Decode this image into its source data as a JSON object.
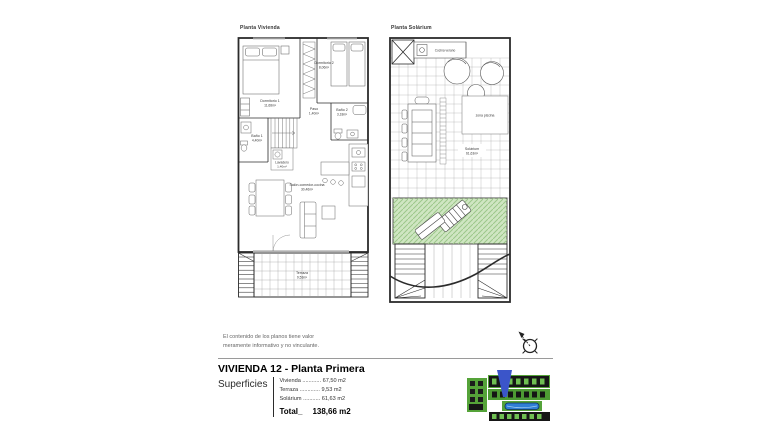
{
  "disclaimer": {
    "line1": "El contenido de los planos tiene valor",
    "line2": "meramente informativo y no vinculante."
  },
  "plans": {
    "vivienda": {
      "title": "Planta Vivienda",
      "rooms": {
        "dormitorio1": {
          "name": "Dormitorio 1",
          "area": "11,68m²"
        },
        "dormitorio2": {
          "name": "Dormitorio 2",
          "area": "8,06m²"
        },
        "bano1": {
          "name": "Baño 1",
          "area": "4,40m²"
        },
        "bano2": {
          "name": "Baño 2",
          "area": "3,18m²"
        },
        "paso": {
          "name": "Paso",
          "area": "1,40m²"
        },
        "lavadero": {
          "name": "Lavadero",
          "area": "1,40m²"
        },
        "salon": {
          "name": "Salón-comedor-cocina",
          "area": "30,46m²"
        },
        "terraza": {
          "name": "Terraza",
          "area": "9,53m²"
        }
      }
    },
    "solarium": {
      "title": "Planta Solárium",
      "labels": {
        "cocina_verano": "Cocina verano",
        "zona_piscina": "zona piscina",
        "solarium_name": "Solárium",
        "solarium_area": "61,63m²"
      }
    }
  },
  "title_block": {
    "title": "VIVIENDA 12 - Planta Primera",
    "superficies_label": "Superficies",
    "rows": [
      {
        "label": "Vivienda",
        "dots": " ............ ",
        "value": "67,50 m2"
      },
      {
        "label": "Terraza",
        "dots": " ............. ",
        "value": "9,53 m2"
      },
      {
        "label": "Solárium",
        "dots": " ........... ",
        "value": "61,63 m2"
      }
    ],
    "total_label": "Total_",
    "total_value": "138,66 m2"
  },
  "colors": {
    "grass_green": "#cfe6c2",
    "grass_hatch": "#9cc78a",
    "map_green": "#55a339",
    "map_pool_blue": "#2f7fd6",
    "map_marker_blue": "#3b55c9"
  }
}
